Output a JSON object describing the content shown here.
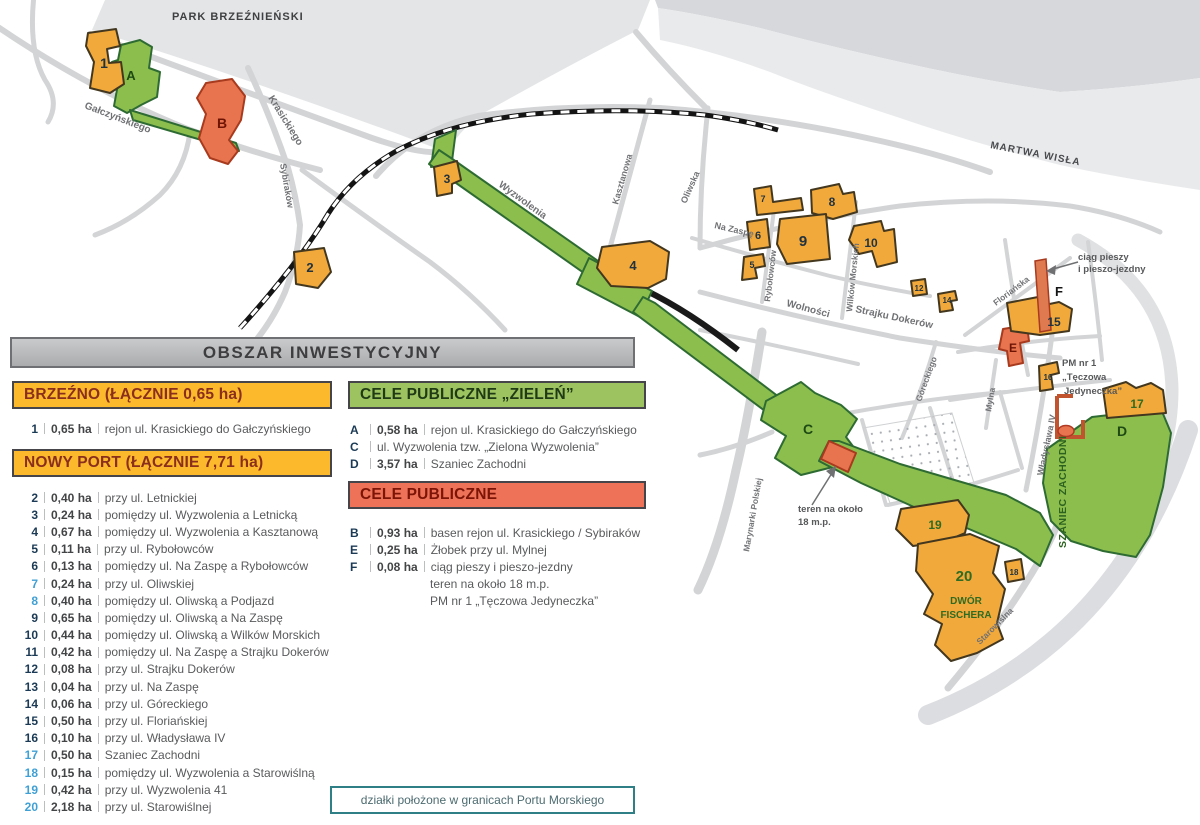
{
  "header": {
    "title": "OBSZAR INWESTYCYJNY"
  },
  "legend": {
    "brzezno": {
      "title": "BRZEŹNO (ŁĄCZNIE 0,65 ha)",
      "items": [
        {
          "num": "1",
          "area": "0,65 ha",
          "desc": "rejon ul. Krasickiego do Gałczyńskiego",
          "port": false
        }
      ]
    },
    "nowy_port": {
      "title": "NOWY PORT (ŁĄCZNIE 7,71 ha)",
      "items": [
        {
          "num": "2",
          "area": "0,40 ha",
          "desc": "przy ul. Letnickiej",
          "port": false
        },
        {
          "num": "3",
          "area": "0,24 ha",
          "desc": "pomiędzy ul. Wyzwolenia a Letnicką",
          "port": false
        },
        {
          "num": "4",
          "area": "0,67 ha",
          "desc": "pomiędzy ul. Wyzwolenia a Kasztanową",
          "port": false
        },
        {
          "num": "5",
          "area": "0,11 ha",
          "desc": "przy ul. Rybołowców",
          "port": false
        },
        {
          "num": "6",
          "area": "0,13 ha",
          "desc": "pomiędzy ul. Na Zaspę a Rybołowców",
          "port": false
        },
        {
          "num": "7",
          "area": "0,24 ha",
          "desc": "przy ul. Oliwskiej",
          "port": true
        },
        {
          "num": "8",
          "area": "0,40 ha",
          "desc": "pomiędzy ul. Oliwską a Podjazd",
          "port": true
        },
        {
          "num": "9",
          "area": "0,65 ha",
          "desc": "pomiędzy ul. Oliwską a Na Zaspę",
          "port": false
        },
        {
          "num": "10",
          "area": "0,44 ha",
          "desc": "pomiędzy ul. Oliwską a Wilków Morskich",
          "port": false
        },
        {
          "num": "11",
          "area": "0,42 ha",
          "desc": "pomiędzy ul. Na Zaspę a Strajku Dokerów",
          "port": false
        },
        {
          "num": "12",
          "area": "0,08 ha",
          "desc": "przy ul. Strajku Dokerów",
          "port": false
        },
        {
          "num": "13",
          "area": "0,04 ha",
          "desc": "przy ul. Na Zaspę",
          "port": false
        },
        {
          "num": "14",
          "area": "0,06 ha",
          "desc": "przy ul. Góreckiego",
          "port": false
        },
        {
          "num": "15",
          "area": "0,50 ha",
          "desc": "przy ul. Floriańskiej",
          "port": false
        },
        {
          "num": "16",
          "area": "0,10 ha",
          "desc": "przy ul. Władysława IV",
          "port": false
        },
        {
          "num": "17",
          "area": "0,50 ha",
          "desc": "Szaniec Zachodni",
          "port": true
        },
        {
          "num": "18",
          "area": "0,15 ha",
          "desc": "pomiędzy ul. Wyzwolenia a Starowiślną",
          "port": true
        },
        {
          "num": "19",
          "area": "0,42 ha",
          "desc": "przy ul. Wyzwolenia 41",
          "port": true
        },
        {
          "num": "20",
          "area": "2,18 ha",
          "desc": "przy ul. Starowiślnej",
          "port": true
        }
      ]
    },
    "green": {
      "title": "CELE PUBLICZNE „ZIELEŃ”",
      "items": [
        {
          "num": "A",
          "area": "0,58 ha",
          "desc": "rejon ul. Krasickiego do Gałczyńskiego"
        },
        {
          "num": "C",
          "area": "",
          "desc": "ul. Wyzwolenia tzw. „Zielona Wyzwolenia”"
        },
        {
          "num": "D",
          "area": "3,57 ha",
          "desc": "Szaniec Zachodni"
        }
      ]
    },
    "public": {
      "title": "CELE PUBLICZNE",
      "items": [
        {
          "num": "B",
          "area": "0,93 ha",
          "desc": "basen rejon ul. Krasickiego / Sybiraków"
        },
        {
          "num": "E",
          "area": "0,25 ha",
          "desc": "Żłobek przy ul. Mylnej"
        },
        {
          "num": "F",
          "area": "0,08 ha",
          "desc": "ciąg pieszy i pieszo-jezdny"
        },
        {
          "num": "",
          "area": "",
          "desc": "teren na około 18 m.p.",
          "cont": true
        },
        {
          "num": "",
          "area": "",
          "desc": "PM nr 1 „Tęczowa Jedyneczka”",
          "cont": true
        }
      ]
    },
    "port_note": "działki położone w granicach Portu Morskiego"
  },
  "map": {
    "park": "PARK BRZEŹNIEŃSKI",
    "river": "MARTWA WISŁA",
    "streets": {
      "galczynskiego": "Gałczyńskiego",
      "krasickiego": "Krasickiego",
      "sybirakow": "Sybiraków",
      "wyzwolenia": "Wyzwolenia",
      "kasztanowa": "Kasztanowa",
      "oliwska": "Oliwska",
      "na_zaspe": "Na Zaspę",
      "rybolowcow": "Rybołowców",
      "wilkow_morskich": "Wilków Morskich",
      "wolnosci": "Wolności",
      "strajku_dokerow": "Strajku Dokerów",
      "goreckiego": "Góreckiego",
      "florianska": "Floriańska",
      "mylna": "Mylna",
      "wladyslawa": "Władysława IV",
      "marynarki": "Marynarki Polskiej",
      "starowislna": "Starowiślna"
    },
    "annotations": {
      "ciag1": "ciąg pieszy",
      "ciag2": "i pieszo-jezdny",
      "teren1": "teren na około",
      "teren2": "18 m.p.",
      "pm1": "PM nr 1",
      "pm2": "„Tęczowa",
      "pm3": "Jedyneczka”",
      "szaniec": "SZANIEC ZACHODNI",
      "dwor1": "DWÓR",
      "dwor2": "FISCHERA"
    },
    "plots": {
      "n1": "1",
      "n2": "2",
      "n3": "3",
      "n4": "4",
      "n5": "5",
      "n6": "6",
      "n7": "7",
      "n8": "8",
      "n9": "9",
      "n10": "10",
      "n12": "12",
      "n14": "14",
      "n15": "15",
      "n16": "16",
      "n17": "17",
      "n18": "18",
      "n19": "19",
      "n20": "20",
      "a": "A",
      "b": "B",
      "c": "C",
      "d": "D",
      "e": "E",
      "f": "F"
    }
  },
  "colors": {
    "header_gray": "#B7B8BA",
    "section_yellow": "#FDB92C",
    "section_green": "#9CC360",
    "section_red": "#EE7257",
    "port_blue": "#3FA0D6",
    "note_teal": "#2F7F86",
    "map_yellow": "#F2A93B",
    "map_green": "#8CBE4D",
    "map_red": "#E8744F"
  }
}
